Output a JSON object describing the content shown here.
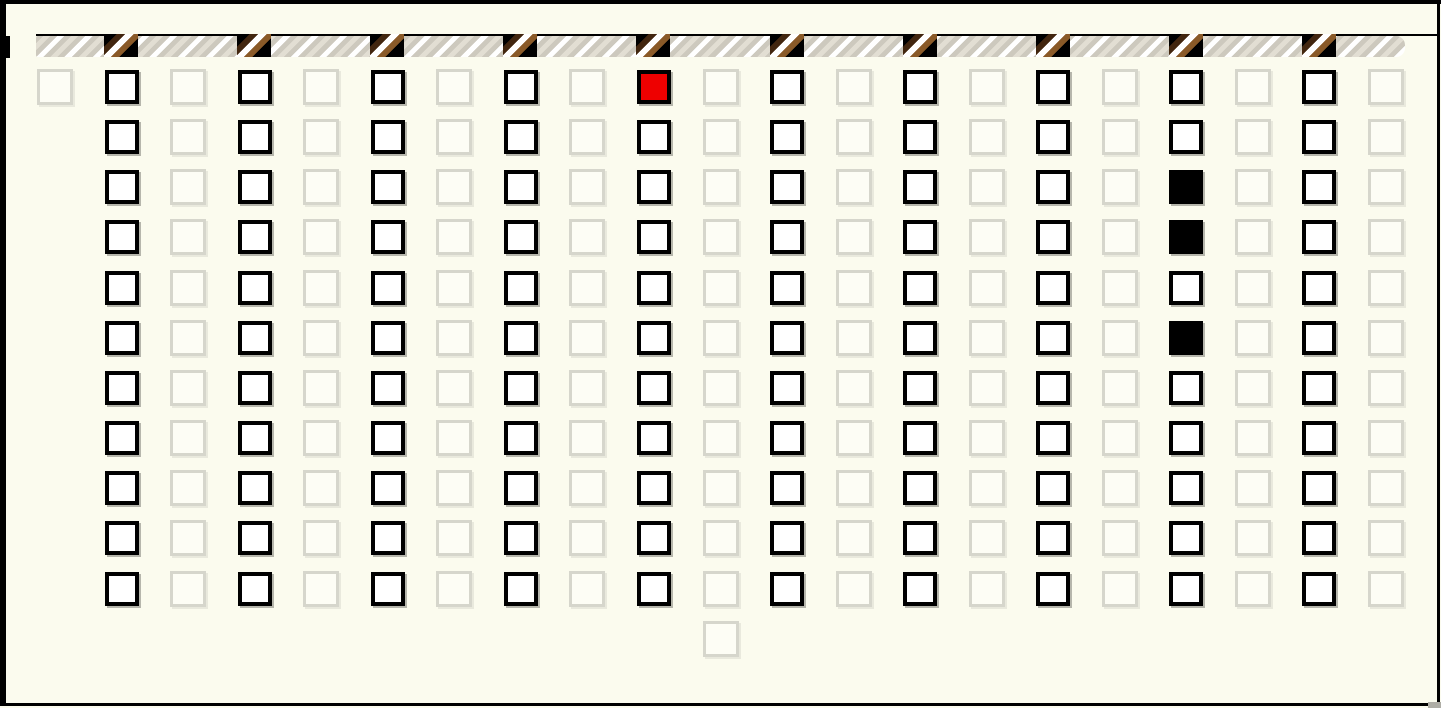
{
  "window": {
    "background": "#fbfbee",
    "frame_color": "#000000"
  },
  "hazard_bar": {
    "stripe_direction": "diagonal-up-right",
    "colors": {
      "base": "#cdc9be",
      "stripe_beige": "#e2ded3",
      "stripe_white": "#ffffff",
      "top_line": "#000000"
    },
    "slots": {
      "count": 10,
      "aligned_with": "active-columns",
      "colors": {
        "background": "#000000",
        "stripe_dark_brown": "#42260f",
        "stripe_white": "#ffffff",
        "stripe_brown": "#8a5a28"
      }
    }
  },
  "board": {
    "columns": 21,
    "rows": 11,
    "column_pattern": "alternating inactive/active starting with inactive",
    "colors": {
      "active_fill": "#ffffff",
      "active_border": "#000000",
      "inactive_fill": "#fdfdf5",
      "inactive_border": "#d6d6cc",
      "red_fill": "#ee0000",
      "black_fill": "#000000",
      "shadow": "#b6b6ac"
    },
    "special_cells": [
      {
        "col": 10,
        "row": 1,
        "state": "red"
      },
      {
        "col": 18,
        "row": 3,
        "state": "black"
      },
      {
        "col": 18,
        "row": 4,
        "state": "black"
      },
      {
        "col": 18,
        "row": 6,
        "state": "black"
      }
    ],
    "single_cell_columns": [
      {
        "col": 1,
        "rows": [
          1
        ]
      }
    ],
    "extra_cells": [
      {
        "col": 11,
        "row": 12,
        "state": "inactive"
      }
    ]
  }
}
